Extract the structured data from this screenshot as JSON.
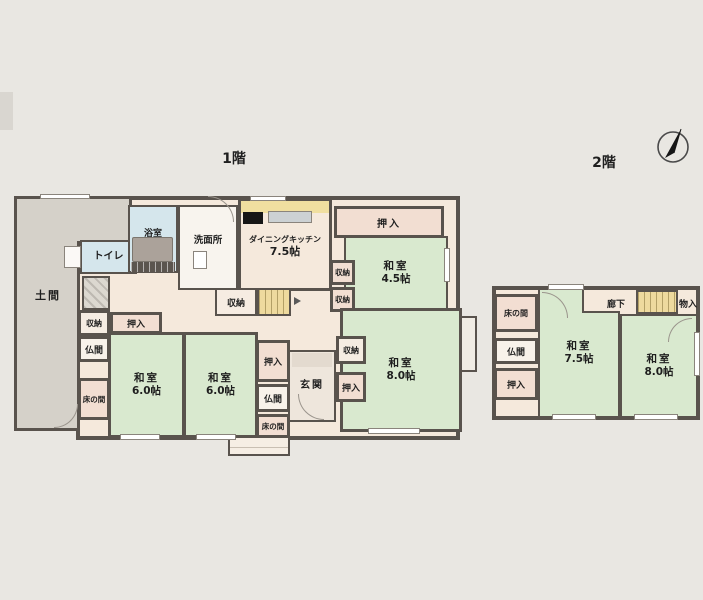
{
  "floor1": {
    "title": "1階",
    "rooms": {
      "doma": "土間",
      "toilet": "トイレ",
      "bath": "浴室",
      "washroom": "洗面所",
      "dining_kitchen": "ダイニングキッチン",
      "dining_kitchen_size": "7.5帖",
      "washitsu_45_size": "4.5帖",
      "washitsu_80_size": "8.0帖",
      "washitsu_60_size": "6.0帖",
      "genkan": "玄関"
    }
  },
  "floor2": {
    "title": "2階",
    "rooms": {
      "washitsu_75_size": "7.5帖",
      "washitsu_80_size": "8.0帖",
      "hallway": "廊下",
      "storage": "物入"
    }
  },
  "terms": {
    "washitsu": "和室",
    "oshiire": "押入",
    "shuno": "収納",
    "butsuma": "仏間",
    "tokonoma": "床の間"
  },
  "icons": {
    "compass": "north-arrow"
  },
  "colors": {
    "wall": "#59534d",
    "tatami_room": "#d9e9cf",
    "wet_area": "#d5e6ec",
    "doma_gray": "#d5d1c9",
    "stairs_yellow": "#eeda9e",
    "background": "#e9e7e2"
  }
}
